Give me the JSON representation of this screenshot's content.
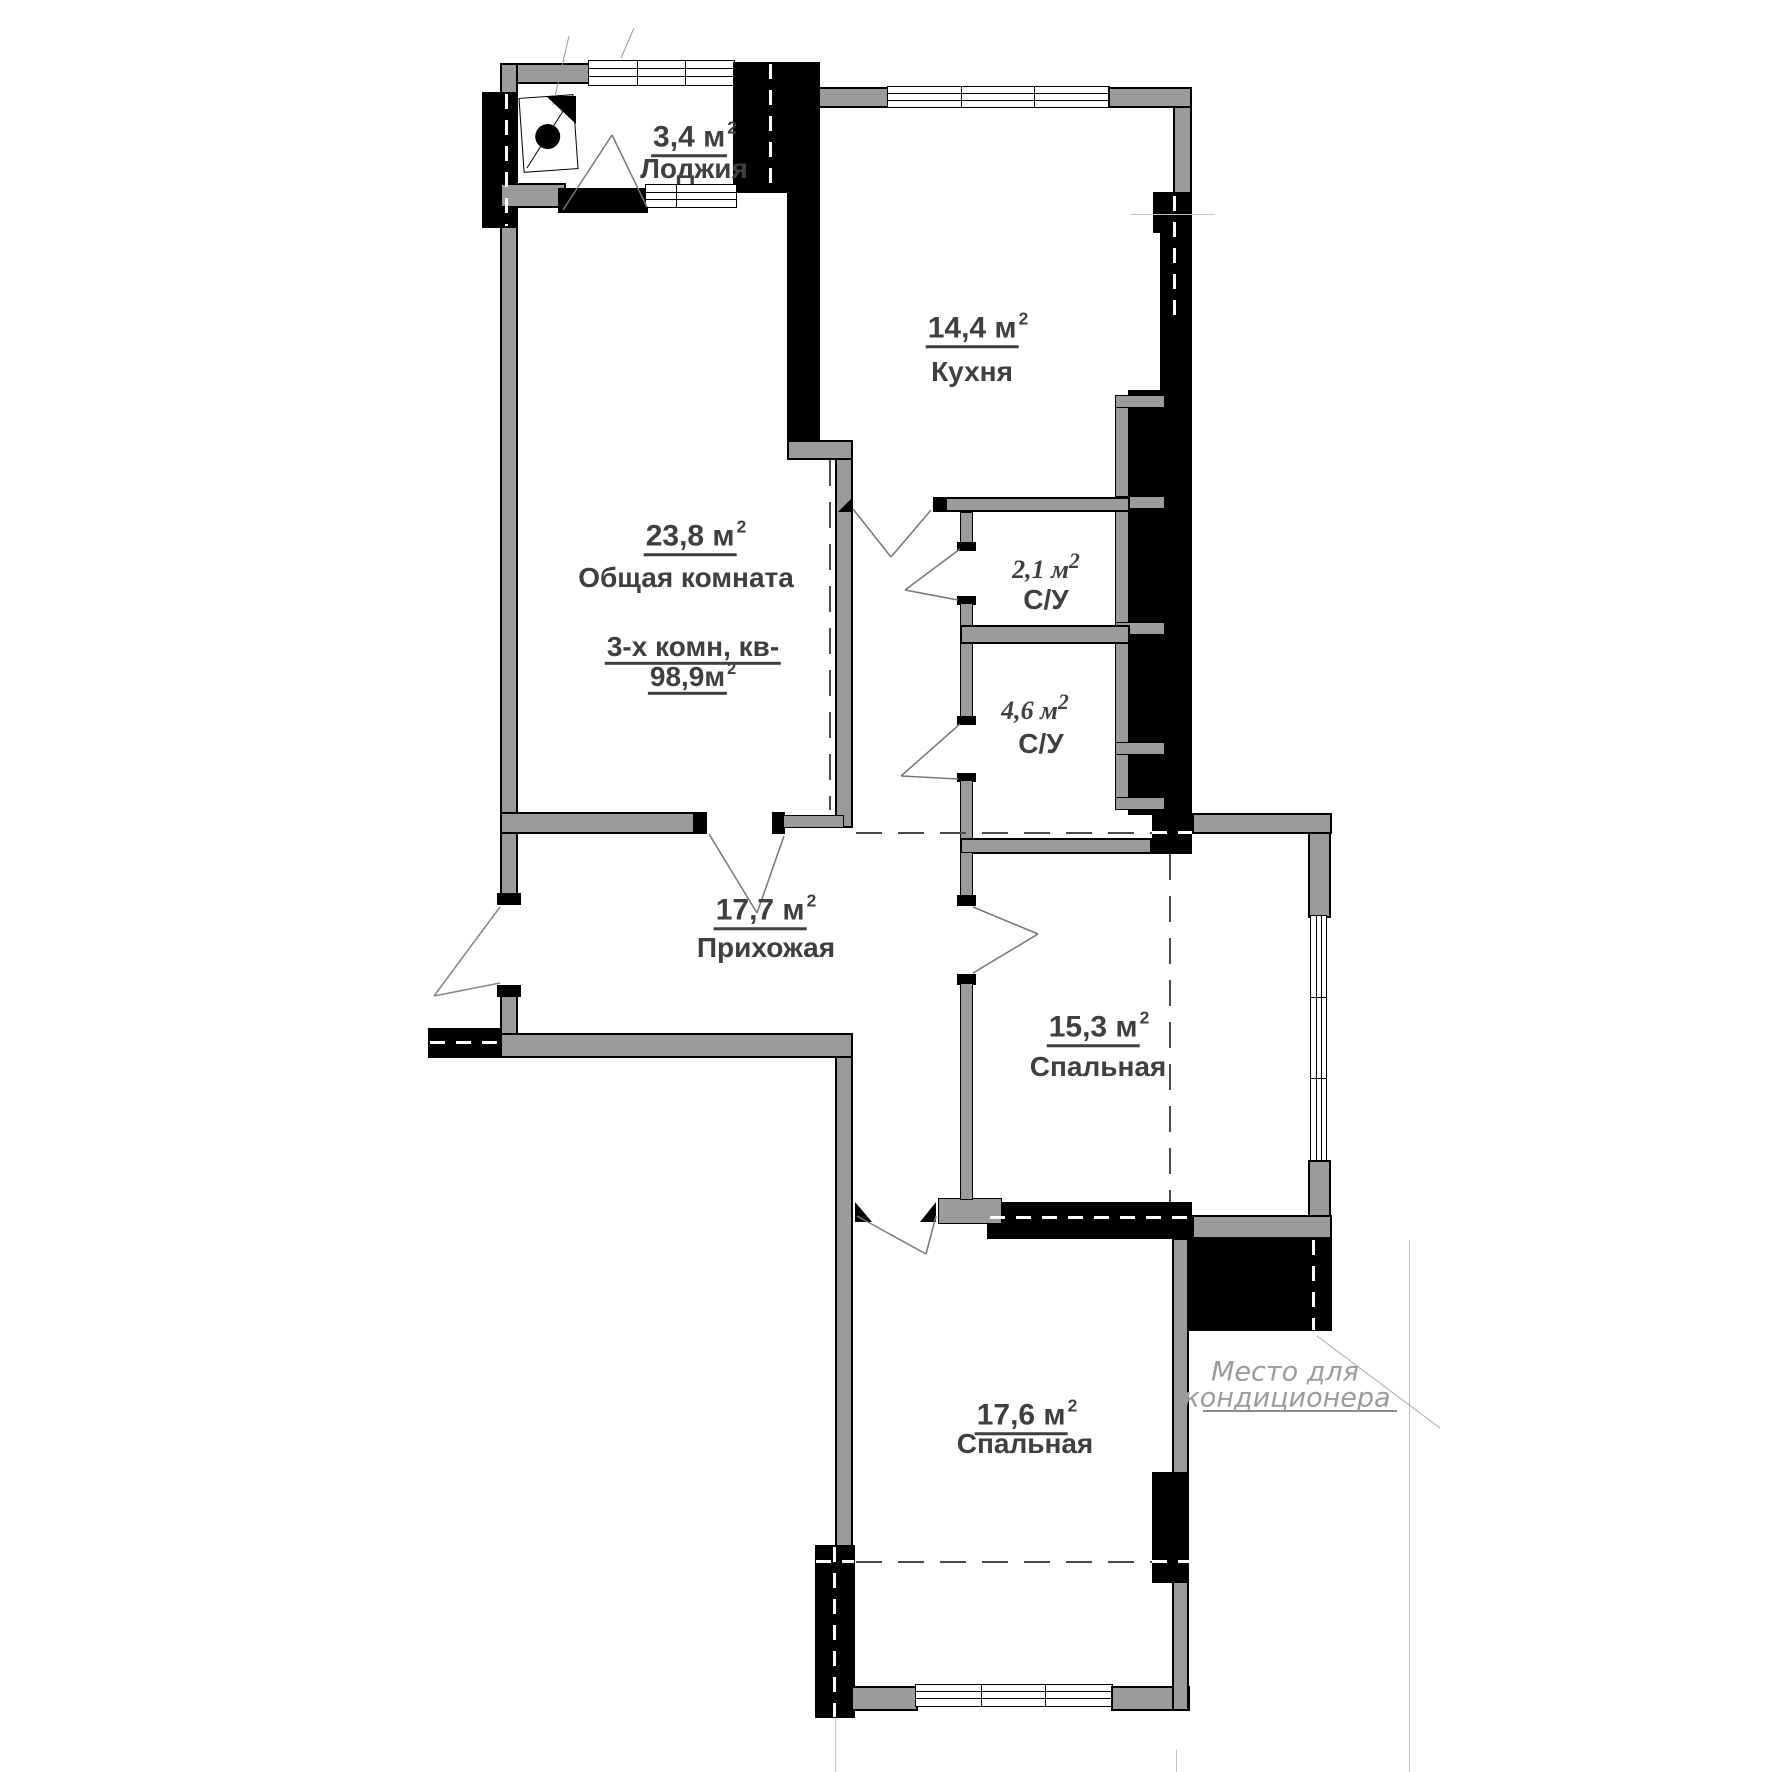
{
  "plan": {
    "apartment": {
      "line1": "3-х комн, кв-",
      "line2_value": "98,9м"
    },
    "rooms": [
      {
        "key": "loggia",
        "area": "3,4 м",
        "name": "Лоджия"
      },
      {
        "key": "kitchen",
        "area": "14,4 м",
        "name": "Кухня"
      },
      {
        "key": "living-room",
        "area": "23,8 м",
        "name": "Общая комната"
      },
      {
        "key": "bathroom-small",
        "area": "2,1 м",
        "name": "С/У"
      },
      {
        "key": "bathroom-large",
        "area": "4,6 м",
        "name": "С/У"
      },
      {
        "key": "hallway",
        "area": "17,7 м",
        "name": "Прихожая"
      },
      {
        "key": "bedroom-1",
        "area": "15,3 м",
        "name": "Спальная"
      },
      {
        "key": "bedroom-2",
        "area": "17,6 м",
        "name": "Спальная"
      }
    ],
    "notes": {
      "ac_line1": "Место для",
      "ac_line2": "кондиционера"
    },
    "sup": "2",
    "colors": {
      "wall_gray": "#9b9b9b",
      "wall_black": "#000000",
      "label": "#3f3f3f",
      "note": "#9b9b9b"
    }
  }
}
